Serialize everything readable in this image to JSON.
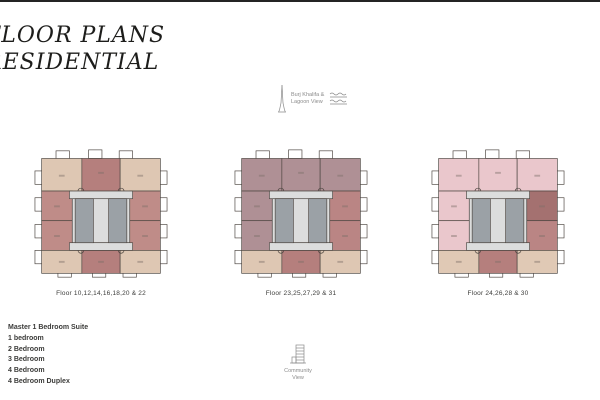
{
  "page": {
    "title_line1": "FLOOR PLANS",
    "title_line2": "RESIDENTIAL"
  },
  "markers": {
    "burj_khalifa": {
      "label_line1": "Burj Khalifa &",
      "label_line2": "Lagoon View"
    },
    "community": {
      "label_line1": "Community",
      "label_line2": "View"
    }
  },
  "floor_plans": [
    {
      "caption": "Floor 10,12,14,16,18,20 & 22",
      "fills": {
        "top_left": "#dec7b3",
        "top_center": "#b57f7d",
        "top_right": "#dec7b3",
        "left_upper": "#bf8c88",
        "left_lower": "#bf8c88",
        "right_upper": "#bf8c88",
        "right_lower": "#bf8c88",
        "bottom_left": "#dec7b3",
        "bottom_center": "#b57f7d",
        "bottom_right": "#dec7b3"
      }
    },
    {
      "caption": "Floor 23,25,27,29 & 31",
      "fills": {
        "top_left": "#af9095",
        "top_center": "#af9095",
        "top_right": "#af9095",
        "left_upper": "#af9095",
        "left_lower": "#af9095",
        "right_upper": "#ba8584",
        "right_lower": "#ba8584",
        "bottom_left": "#dec7b3",
        "bottom_center": "#b57f7d",
        "bottom_right": "#dec7b3"
      }
    },
    {
      "caption": "Floor 24,26,28 & 30",
      "fills": {
        "top_left": "#eac7cc",
        "top_center": "#eac7cc",
        "top_right": "#eac7cc",
        "left_upper": "#eac7cc",
        "left_lower": "#eac7cc",
        "right_upper": "#a47170",
        "right_lower": "#ba8584",
        "bottom_left": "#e0c9b5",
        "bottom_center": "#b57f7d",
        "bottom_right": "#e0c9b5"
      }
    }
  ],
  "legend": {
    "items": [
      "Master 1 Bedroom Suite",
      "1 bedroom",
      "2 Bedroom",
      "3 Bedroom",
      "4 Bedroom",
      "4 Bedroom Duplex"
    ]
  },
  "palette": {
    "core_dark": "#9ba1a6",
    "core_light": "#dcdddd",
    "outline": "#4c4540",
    "white": "#ffffff",
    "label_mark": "#7d6f68",
    "edge_bar": "#242424",
    "icon_gray": "#8a8a8a",
    "text_dark": "#1d1d1b"
  }
}
